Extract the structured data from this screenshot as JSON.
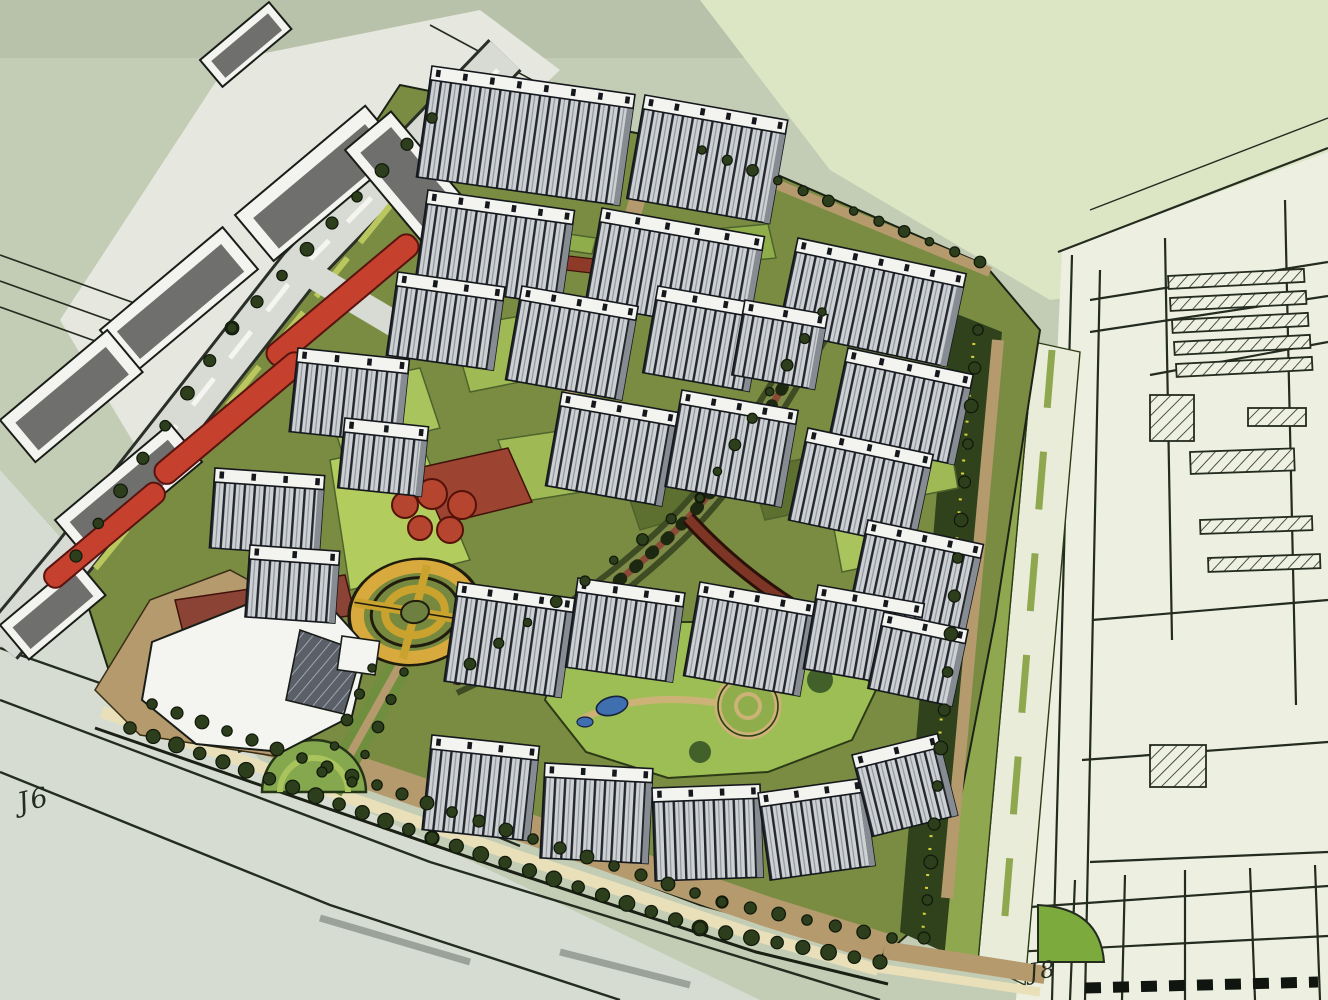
{
  "scene": {
    "labels": {
      "j6": "J6",
      "j8": "J8"
    },
    "palette": {
      "background": "#c3ccb4",
      "paper": "#edf0e1",
      "ground_olive": "#7a8c42",
      "lawn_bright": "#a9c45c",
      "road_tan": "#b59a6d",
      "sidewalk_cream": "#e9e0ba",
      "building_white": "#f3f4ef",
      "facade_gray": "#ced1d4",
      "roof_dark_gray": "#6f706e",
      "red_building": "#c6402e",
      "brick_plaza": "#9c4331",
      "gold_plaza": "#d8a93c",
      "tree_green": "#2c3e1b",
      "median_green": "#8fa84f",
      "water_blue": "#3f6fae",
      "ink": "#242b1f"
    },
    "towers": [
      {
        "x": 432,
        "y": 66,
        "w": 205,
        "h": 112,
        "r": 8
      },
      {
        "x": 645,
        "y": 95,
        "w": 145,
        "h": 105,
        "r": 10
      },
      {
        "x": 428,
        "y": 190,
        "w": 148,
        "h": 95,
        "r": 8
      },
      {
        "x": 602,
        "y": 208,
        "w": 165,
        "h": 98,
        "r": 10
      },
      {
        "x": 798,
        "y": 238,
        "w": 172,
        "h": 95,
        "r": 12
      },
      {
        "x": 848,
        "y": 348,
        "w": 128,
        "h": 92,
        "r": 12
      },
      {
        "x": 298,
        "y": 348,
        "w": 112,
        "h": 84,
        "r": 6
      },
      {
        "x": 398,
        "y": 272,
        "w": 108,
        "h": 84,
        "r": 8
      },
      {
        "x": 215,
        "y": 468,
        "w": 110,
        "h": 80,
        "r": 4
      },
      {
        "x": 522,
        "y": 286,
        "w": 118,
        "h": 95,
        "r": 10
      },
      {
        "x": 658,
        "y": 286,
        "w": 108,
        "h": 88,
        "r": 10
      },
      {
        "x": 562,
        "y": 392,
        "w": 118,
        "h": 95,
        "r": 10
      },
      {
        "x": 682,
        "y": 390,
        "w": 118,
        "h": 98,
        "r": 10
      },
      {
        "x": 808,
        "y": 428,
        "w": 128,
        "h": 94,
        "r": 12
      },
      {
        "x": 868,
        "y": 520,
        "w": 118,
        "h": 88,
        "r": 12
      },
      {
        "x": 458,
        "y": 582,
        "w": 118,
        "h": 100,
        "r": 8
      },
      {
        "x": 578,
        "y": 578,
        "w": 108,
        "h": 90,
        "r": 8
      },
      {
        "x": 700,
        "y": 582,
        "w": 118,
        "h": 95,
        "r": 10
      },
      {
        "x": 818,
        "y": 585,
        "w": 108,
        "h": 85,
        "r": 10
      },
      {
        "x": 884,
        "y": 612,
        "w": 86,
        "h": 78,
        "r": 12
      },
      {
        "x": 432,
        "y": 735,
        "w": 108,
        "h": 95,
        "r": 6
      },
      {
        "x": 545,
        "y": 763,
        "w": 108,
        "h": 95,
        "r": 3
      },
      {
        "x": 652,
        "y": 788,
        "w": 108,
        "h": 93,
        "r": -2
      },
      {
        "x": 758,
        "y": 793,
        "w": 106,
        "h": 88,
        "r": -8
      },
      {
        "x": 852,
        "y": 755,
        "w": 88,
        "h": 84,
        "r": -14
      },
      {
        "x": 250,
        "y": 545,
        "w": 90,
        "h": 72,
        "r": 4
      },
      {
        "x": 345,
        "y": 418,
        "w": 84,
        "h": 70,
        "r": 6
      },
      {
        "x": 745,
        "y": 300,
        "w": 84,
        "h": 76,
        "r": 10
      }
    ],
    "tree_rows": [
      {
        "x1": 130,
        "y1": 728,
        "x2": 432,
        "y2": 838,
        "n": 14,
        "r": 7
      },
      {
        "x1": 432,
        "y1": 838,
        "x2": 700,
        "y2": 928,
        "n": 12,
        "r": 7
      },
      {
        "x1": 700,
        "y1": 928,
        "x2": 880,
        "y2": 962,
        "n": 8,
        "r": 7
      },
      {
        "x1": 152,
        "y1": 704,
        "x2": 452,
        "y2": 812,
        "n": 13,
        "r": 6
      },
      {
        "x1": 452,
        "y1": 812,
        "x2": 722,
        "y2": 902,
        "n": 11,
        "r": 6
      },
      {
        "x1": 722,
        "y1": 902,
        "x2": 892,
        "y2": 938,
        "n": 7,
        "r": 6
      },
      {
        "x1": 432,
        "y1": 118,
        "x2": 232,
        "y2": 328,
        "n": 9,
        "r": 6
      },
      {
        "x1": 232,
        "y1": 328,
        "x2": 76,
        "y2": 556,
        "n": 8,
        "r": 6
      },
      {
        "x1": 978,
        "y1": 330,
        "x2": 924,
        "y2": 938,
        "n": 17,
        "r": 6
      },
      {
        "x1": 702,
        "y1": 150,
        "x2": 980,
        "y2": 262,
        "n": 12,
        "r": 5
      },
      {
        "x1": 822,
        "y1": 312,
        "x2": 700,
        "y2": 498,
        "n": 8,
        "r": 5
      },
      {
        "x1": 700,
        "y1": 498,
        "x2": 470,
        "y2": 664,
        "n": 9,
        "r": 5
      },
      {
        "x1": 372,
        "y1": 668,
        "x2": 322,
        "y2": 772,
        "n": 5,
        "r": 5
      },
      {
        "x1": 404,
        "y1": 672,
        "x2": 352,
        "y2": 782,
        "n": 5,
        "r": 5
      }
    ]
  }
}
